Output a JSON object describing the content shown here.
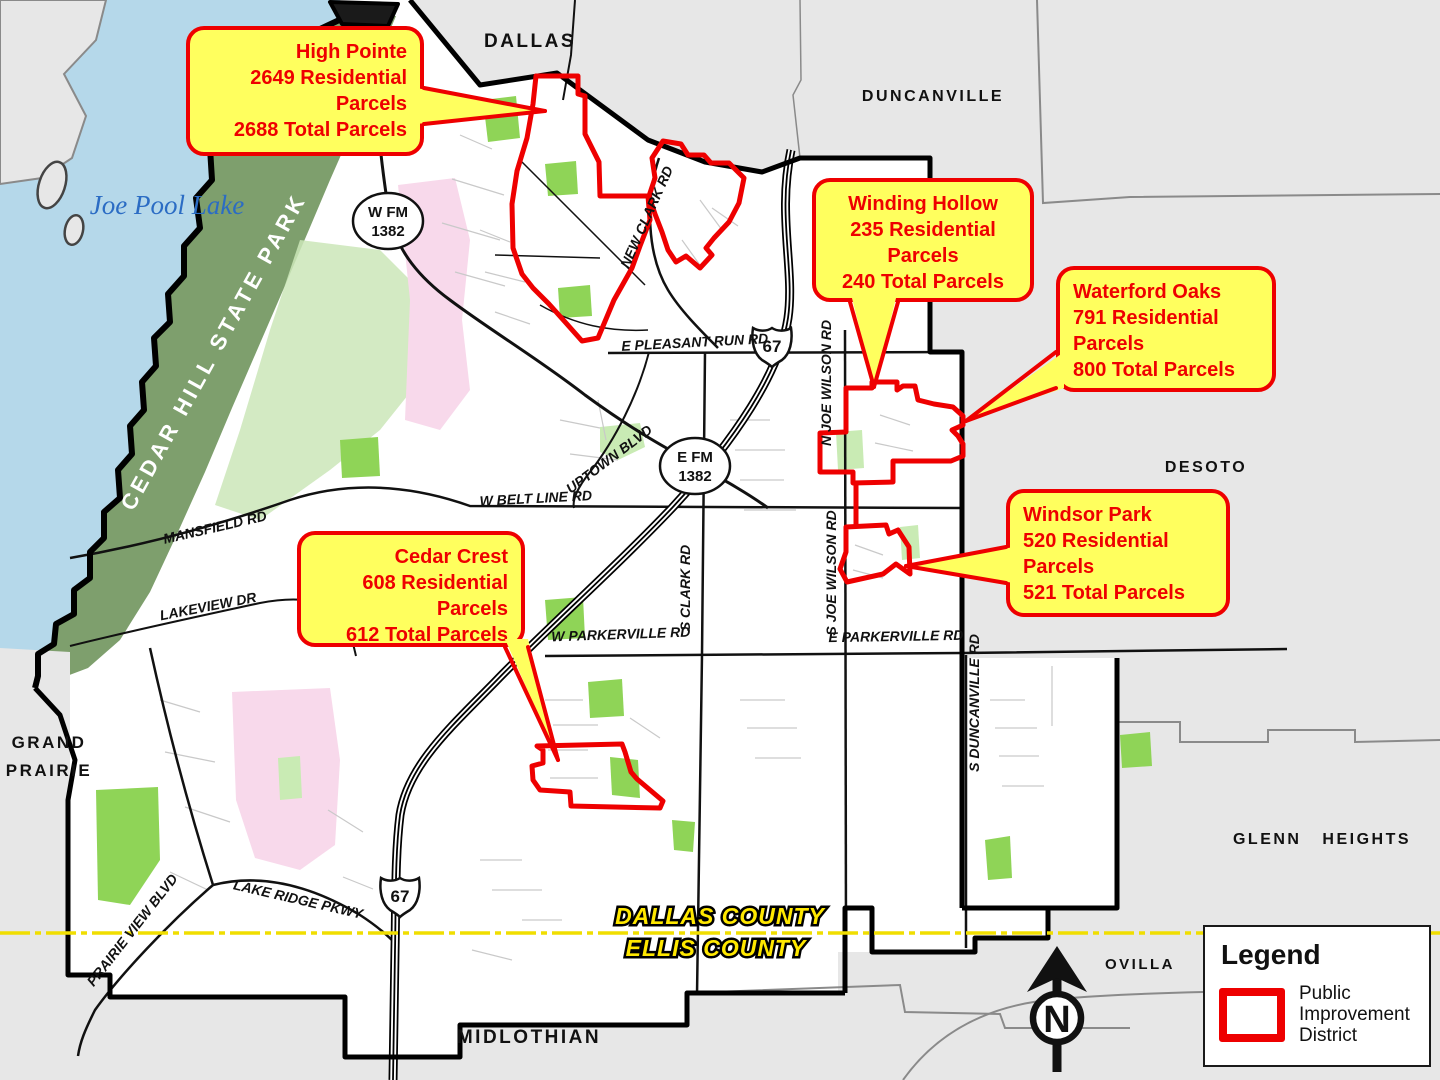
{
  "callouts": {
    "high_pointe": {
      "title": "High Pointe",
      "residential": "2649 Residential Parcels",
      "total": "2688 Total Parcels"
    },
    "winding_hollow": {
      "title": "Winding Hollow",
      "residential": "235 Residential Parcels",
      "total": "240 Total Parcels"
    },
    "waterford_oaks": {
      "title": "Waterford Oaks",
      "residential": "791 Residential Parcels",
      "total": "800 Total Parcels"
    },
    "windsor_park": {
      "title": "Windsor Park",
      "residential": "520 Residential Parcels",
      "total": "521 Total Parcels"
    },
    "cedar_crest": {
      "title": "Cedar Crest",
      "residential": "608 Residential Parcels",
      "total": "612 Total Parcels"
    }
  },
  "legend": {
    "title": "Legend",
    "pid_label": "Public Improvement District"
  },
  "compass": {
    "north_label": "N"
  },
  "cities": {
    "dallas": "DALLAS",
    "duncanville": "DUNCANVILLE",
    "desoto": "DESOTO",
    "glenn_heights": "GLENN HEIGHTS",
    "ovilla": "OVILLA",
    "midlothian": "MIDLOTHIAN",
    "grand_prairie_line1": "GRAND",
    "grand_prairie_line2": "PRAIRIE"
  },
  "county_labels": {
    "dallas_county": "DALLAS COUNTY",
    "ellis_county": "ELLIS COUNTY"
  },
  "water_labels": {
    "joe_pool_lake": "Joe Pool Lake"
  },
  "park_labels": {
    "cedar_hill_state_park": "CEDAR HILL STATE PARK"
  },
  "road_labels": {
    "e_pleasant_run": "E PLEASANT RUN RD",
    "w_belt_line": "W BELT LINE RD",
    "mansfield": "MANSFIELD RD",
    "lakeview": "LAKEVIEW DR",
    "w_parkerville": "W PARKERVILLE RD",
    "e_parkerville": "E PARKERVILLE RD",
    "s_clark": "S CLARK RD",
    "n_joe_wilson": "N JOE WILSON RD",
    "s_joe_wilson": "S JOE WILSON RD",
    "s_duncanville": "S DUNCANVILLE RD",
    "uptown": "UPTOWN BLVD",
    "new_clark": "NEW CLARK RD",
    "prairie_view": "PRAIRIE VIEW BLVD",
    "lake_ridge": "LAKE RIDGE PKWY"
  },
  "highway_shields": {
    "w_fm_line1": "W FM",
    "w_fm_line2": "1382",
    "e_fm_line1": "E FM",
    "e_fm_line2": "1382",
    "us_67": "67"
  },
  "colors": {
    "district_red": "#EE0000",
    "callout_yellow": "#FFFF5E",
    "county_line_yellow": "#F0DE00",
    "park_green": "#7E9F6D",
    "lake_blue": "#B5D8EA",
    "outside_gray": "#E7E7E7"
  }
}
